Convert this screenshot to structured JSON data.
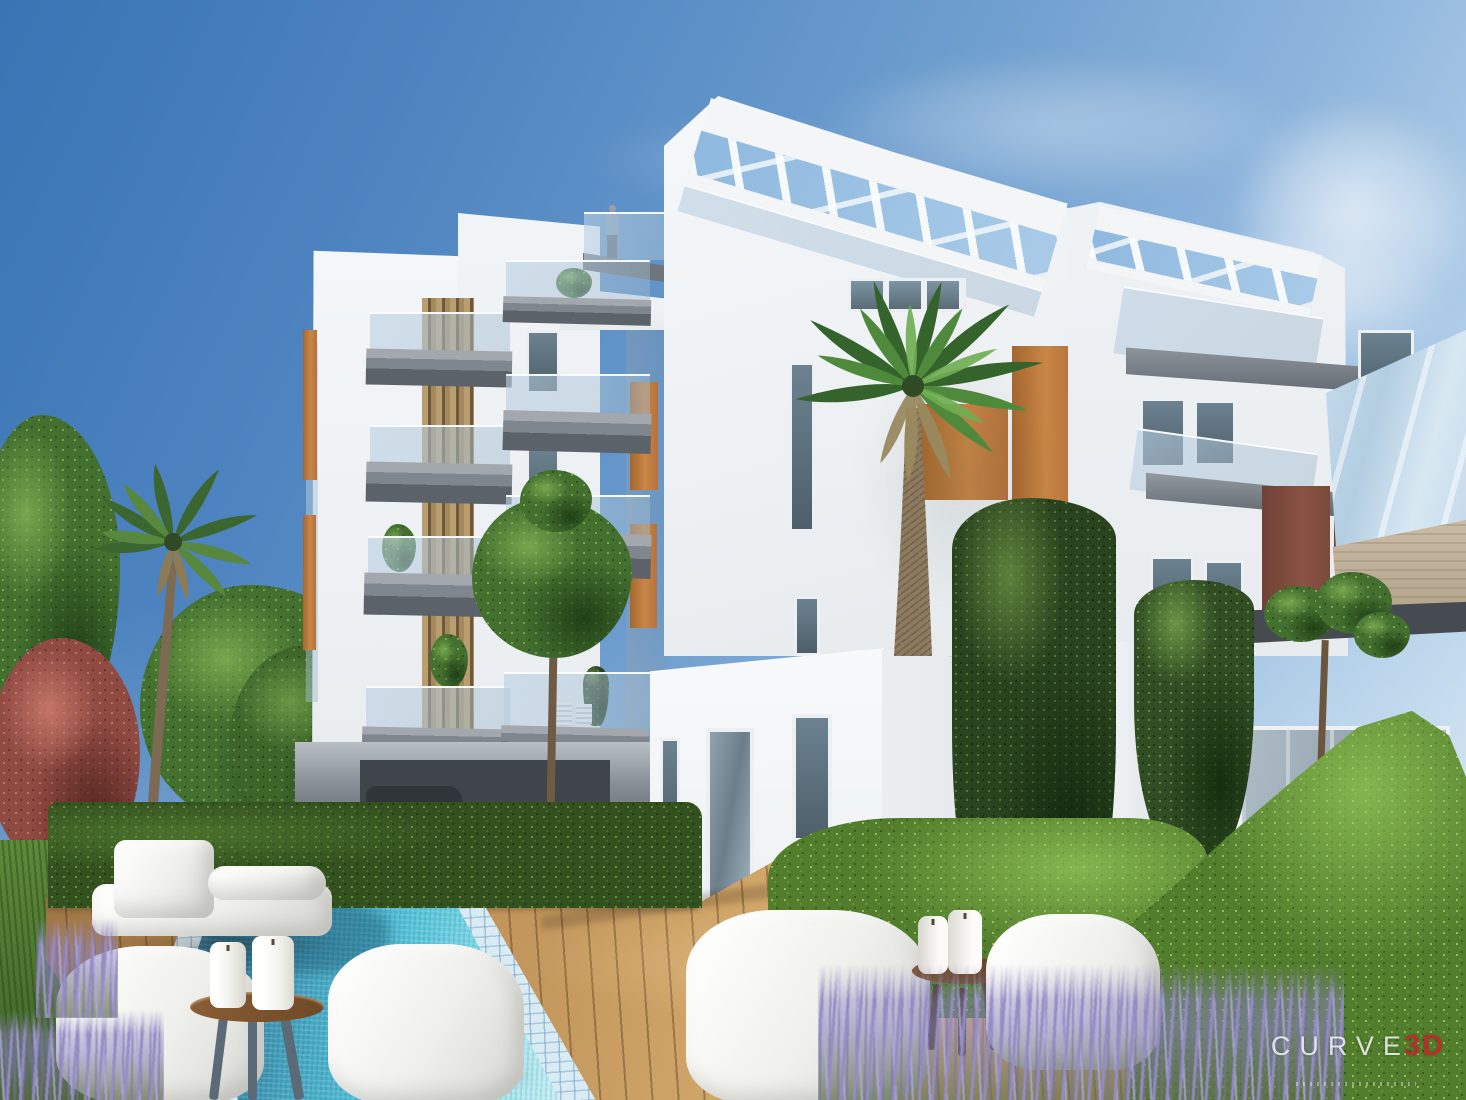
{
  "meta": {
    "description": "Photorealistic 3D architectural rendering: modern white apartment building with rooftop pergolas, glass balconies, wood louvers and terracotta accent panels; garden with swimming pool, timber deck, white bean-bag seats, candle stools, palms, cypresses, hedges and lavender under a clear blue sky; a person stands on the roof terrace."
  },
  "watermark": {
    "brand": "CURVE",
    "suffix": "3D",
    "tagline_legible": false,
    "brand_color": "#f0f4f6",
    "suffix_color": "#b2322b"
  },
  "palette": {
    "sky_top": "#3a74b4",
    "sky_horizon": "#dceaf5",
    "building_white": "#f2f4f6",
    "building_shade": "#dde2e7",
    "balcony_slab_gray": "#7d838a",
    "balcony_glass": "#b8cfe0",
    "accent_terracotta": "#bd783c",
    "accent_maroon": "#7a493b",
    "wood_louver": "#b99e70",
    "pergola_sky_gap": "#9cc2e2",
    "travertine_beam": "#c7b9a1",
    "pool_water_deep": "#2b6d92",
    "pool_water_bright": "#52c2d8",
    "pool_coping_tile": "#d9ecf4",
    "deck_wood": "#c49a62",
    "hedge_dark": "#33511f",
    "hedge_bright": "#6fa03f",
    "conifer_green": "#2a431f",
    "lavender_purple": "#948cc6",
    "red_shrub": "#a5514a",
    "furniture_white": "#f7f7f5",
    "stool_wood": "#8a5e36",
    "stool_legs_slate": "#5a6a76",
    "car_red": "#9e3126"
  },
  "scene": {
    "building": {
      "rooftop_pergolas": 2,
      "person_on_roof_terrace": 1,
      "balcony_stacks_left_tower": 2
    },
    "pool": {
      "shape": "rectangular",
      "tiled_border": true
    },
    "furniture": {
      "bean_bag_chairs": 4,
      "day_bed": 1,
      "candle_stools": 2,
      "candles": 4
    },
    "vegetation": {
      "palm_trees": 2,
      "cypress_conifers": 2,
      "hedges": 3,
      "lavender_clumps": 3,
      "red_shrub": 1,
      "small_trees": 3
    }
  }
}
